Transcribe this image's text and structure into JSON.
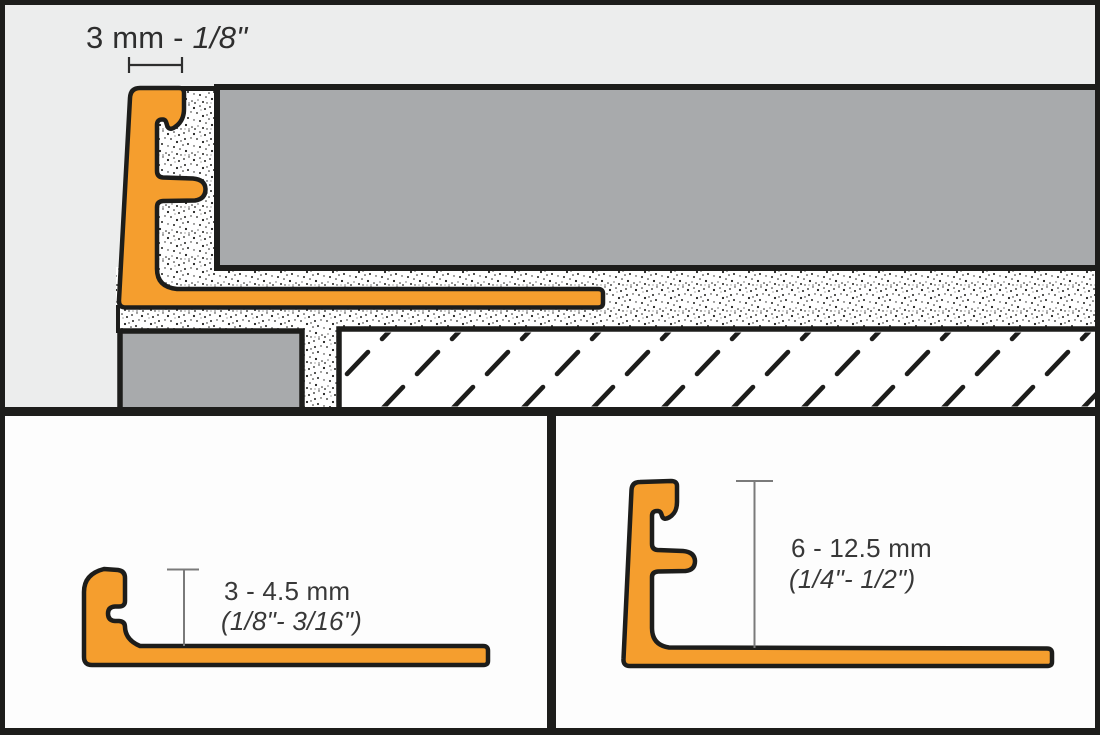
{
  "installation_panel": {
    "dimension_label": {
      "prefix": "3 mm - ",
      "fraction": "1/8\""
    }
  },
  "small_profile_panel": {
    "metric_label": "3 - 4.5 mm",
    "imperial_label": "(1/8\"- 3/16\")"
  },
  "large_profile_panel": {
    "metric_label": "6 - 12.5 mm",
    "imperial_label": "(1/4\"- 1/2\")"
  },
  "colors": {
    "profile_orange": "#F59E2E",
    "tile_gray": "#A8AAAC",
    "outline_black": "#1D1D1B",
    "installation_bg": "#ECEDED",
    "detail_panel_bg": "#FDFDFD",
    "dimension_line_gray": "#7A7A7A",
    "dimension_line_dark": "#2E2E2E",
    "label_text": "#383838"
  }
}
